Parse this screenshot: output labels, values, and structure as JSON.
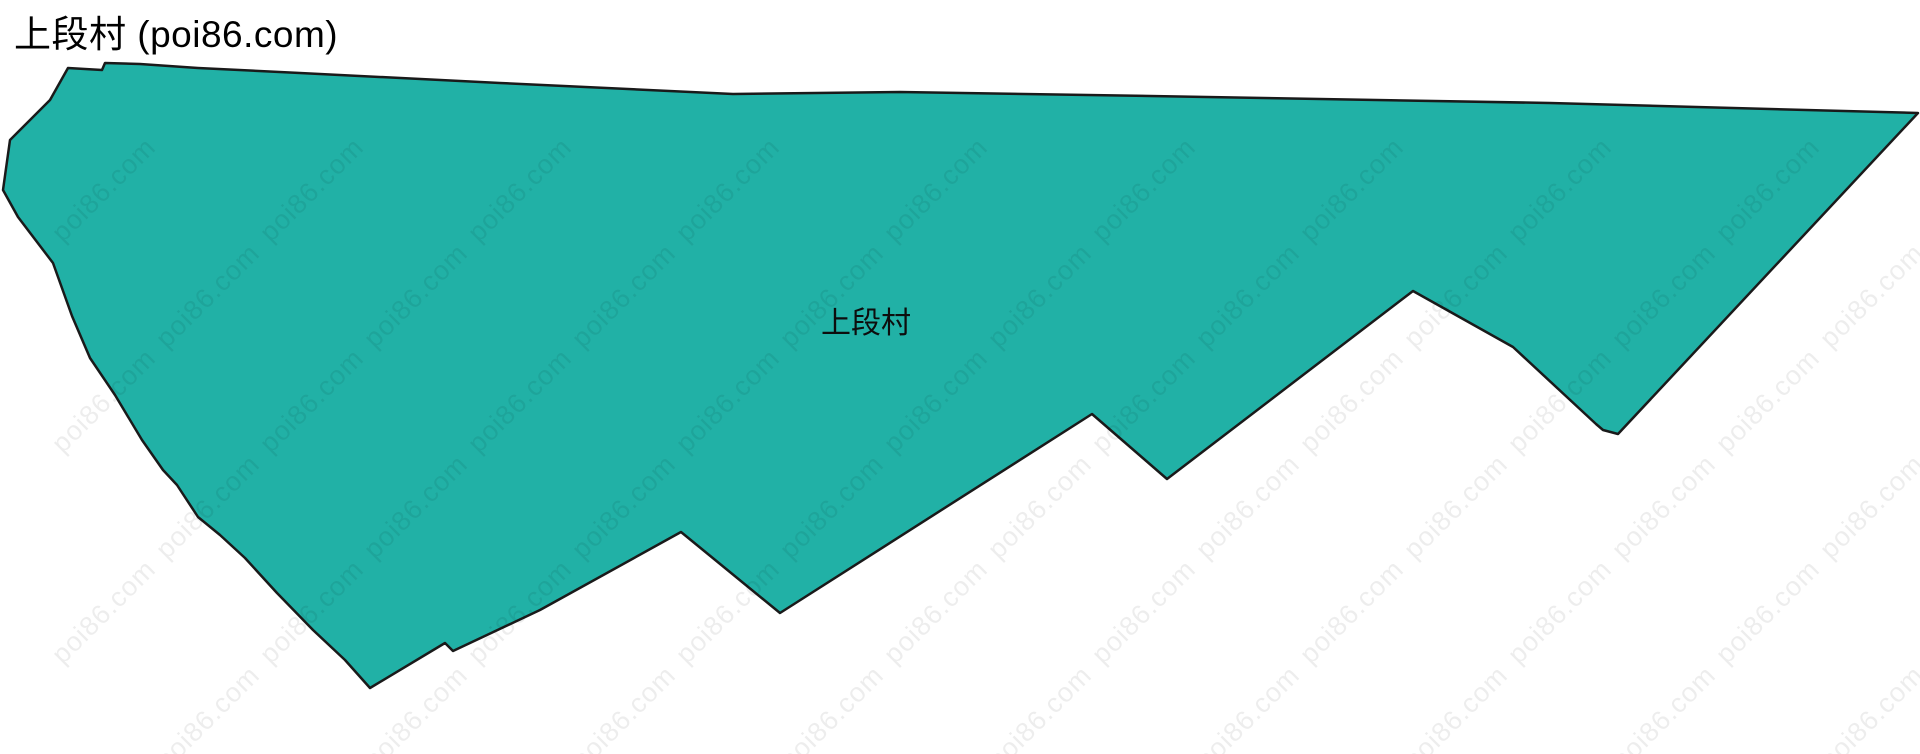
{
  "header": {
    "title": "上段村 (poi86.com)"
  },
  "map": {
    "label": "上段村",
    "label_position": {
      "x": 866,
      "y": 320
    },
    "fill_color": "#21b1a6",
    "stroke_color": "#1a1a1a",
    "stroke_width": 2.5,
    "polygon_points": [
      [
        68,
        68
      ],
      [
        102,
        70
      ],
      [
        105,
        63
      ],
      [
        140,
        64
      ],
      [
        198,
        68
      ],
      [
        300,
        73
      ],
      [
        500,
        83
      ],
      [
        733,
        94
      ],
      [
        900,
        92
      ],
      [
        1150,
        96
      ],
      [
        1550,
        103
      ],
      [
        1918,
        113
      ],
      [
        1618,
        434
      ],
      [
        1603,
        430
      ],
      [
        1596,
        424
      ],
      [
        1513,
        347
      ],
      [
        1413,
        291
      ],
      [
        1167,
        479
      ],
      [
        1092,
        414
      ],
      [
        780,
        613
      ],
      [
        681,
        532
      ],
      [
        540,
        610
      ],
      [
        453,
        651
      ],
      [
        445,
        643
      ],
      [
        370,
        688
      ],
      [
        345,
        660
      ],
      [
        313,
        630
      ],
      [
        277,
        593
      ],
      [
        245,
        558
      ],
      [
        220,
        535
      ],
      [
        198,
        517
      ],
      [
        177,
        485
      ],
      [
        163,
        470
      ],
      [
        142,
        440
      ],
      [
        115,
        395
      ],
      [
        90,
        358
      ],
      [
        72,
        316
      ],
      [
        53,
        263
      ],
      [
        18,
        217
      ],
      [
        3,
        190
      ],
      [
        10,
        140
      ],
      [
        28,
        122
      ],
      [
        50,
        100
      ]
    ]
  },
  "watermark": {
    "text": "poi86.com",
    "color": "rgba(0,0,0,0.07)"
  }
}
